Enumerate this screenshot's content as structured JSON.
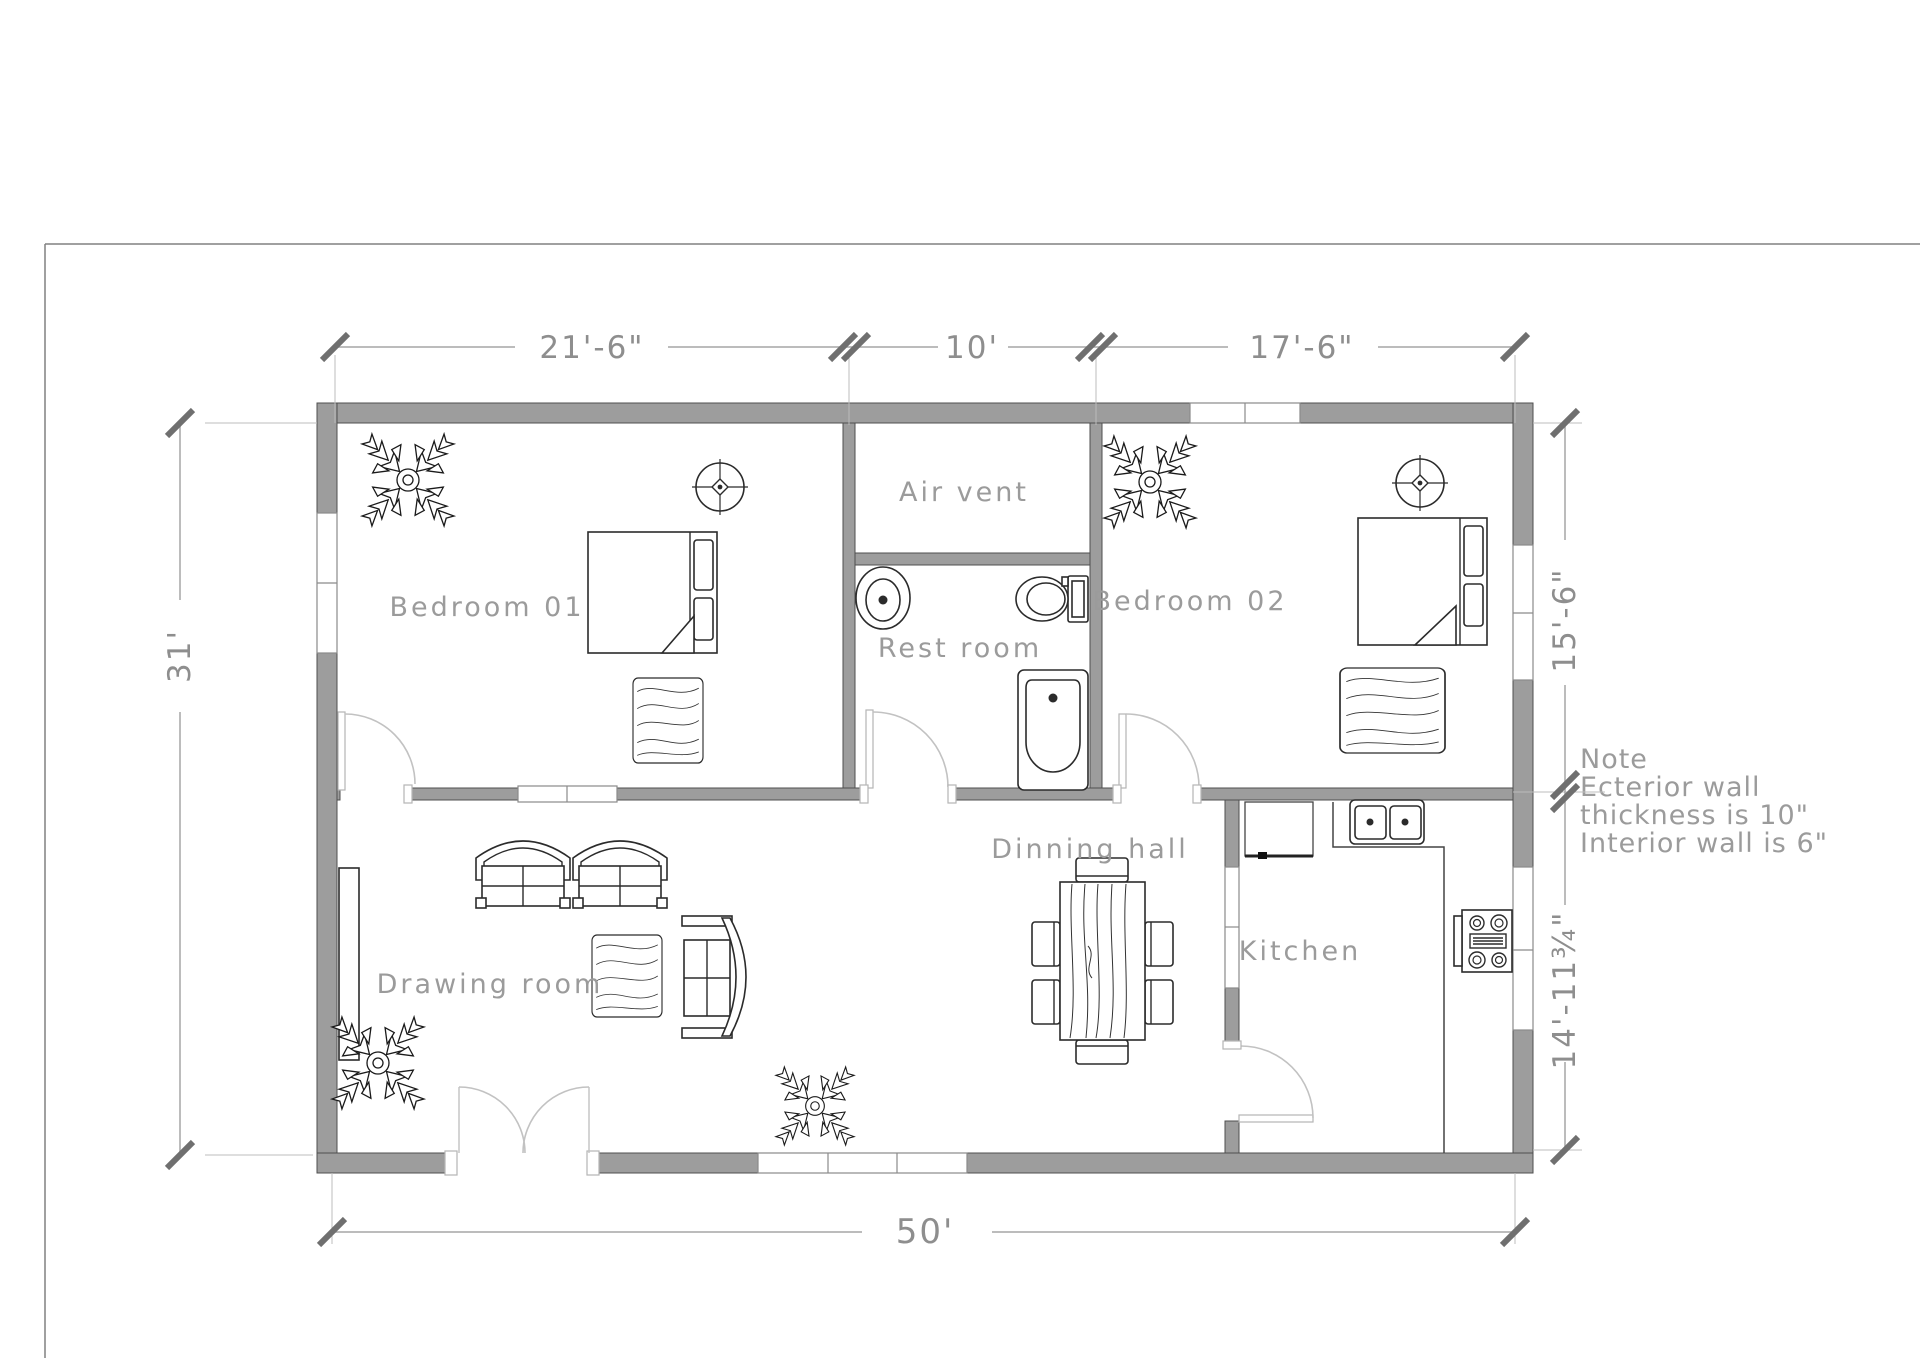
{
  "title": "House floor plan drawing",
  "dimensions": {
    "top": [
      "21'-6\"",
      "10'",
      "17'-6\""
    ],
    "left": "31'",
    "right_upper": "15'-6\"",
    "right_lower": "14'-11¾\"",
    "bottom": "50'"
  },
  "rooms": {
    "bedroom1": "Bedroom 01",
    "air_vent": "Air vent",
    "rest_room": "Rest room",
    "bedroom2": "Bedroom 02",
    "dining": "Dinning hall",
    "kitchen": "Kitchen",
    "drawing": "Drawing room"
  },
  "note": [
    "Note",
    "Ecterior wall",
    "thickness is 10\"",
    "Interior wall is 6\""
  ],
  "colors": {
    "wall": "#9d9d9d",
    "wall_edge": "#4f4f4f",
    "furniture_line": "#2b2b2b",
    "dimension_line": "#a6a6a6",
    "dimension_text": "#8e8e8e",
    "label_text": "#9b9b9b",
    "door_swing": "#c2c2c2",
    "page_border": "#808080"
  }
}
